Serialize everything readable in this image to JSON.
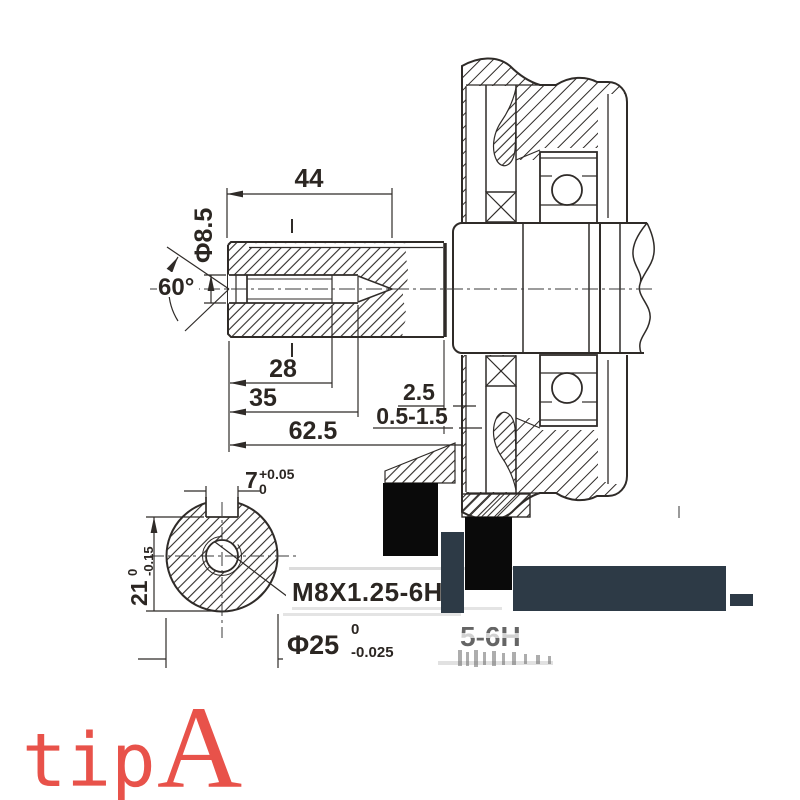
{
  "dims": {
    "len_keyway": "44",
    "dia_thread": "Φ8.5",
    "angle": "60°",
    "depth_thread": "28",
    "depth_hole": "35",
    "len_shaft": "62.5",
    "step": "2.5",
    "clearance": "0.5-1.5",
    "key_w": "7",
    "key_w_sup": "+0.05",
    "key_w_sub": "0",
    "key_h": "21",
    "key_h_sup": "0",
    "key_h_sub": "-0.15",
    "thread_note": "M8X1.25-6H",
    "dia_shaft": "Φ25",
    "dia_shaft_sup": "0",
    "dia_shaft_sub": "-0.025"
  },
  "ghost": {
    "text": "5-6H"
  },
  "caption": {
    "word": "tip",
    "letter": "A",
    "color": "#e8524a"
  },
  "colors": {
    "line": "#2f2b28",
    "redaction_black": "#0a0a0a",
    "redaction_navy": "#2d3a46"
  }
}
